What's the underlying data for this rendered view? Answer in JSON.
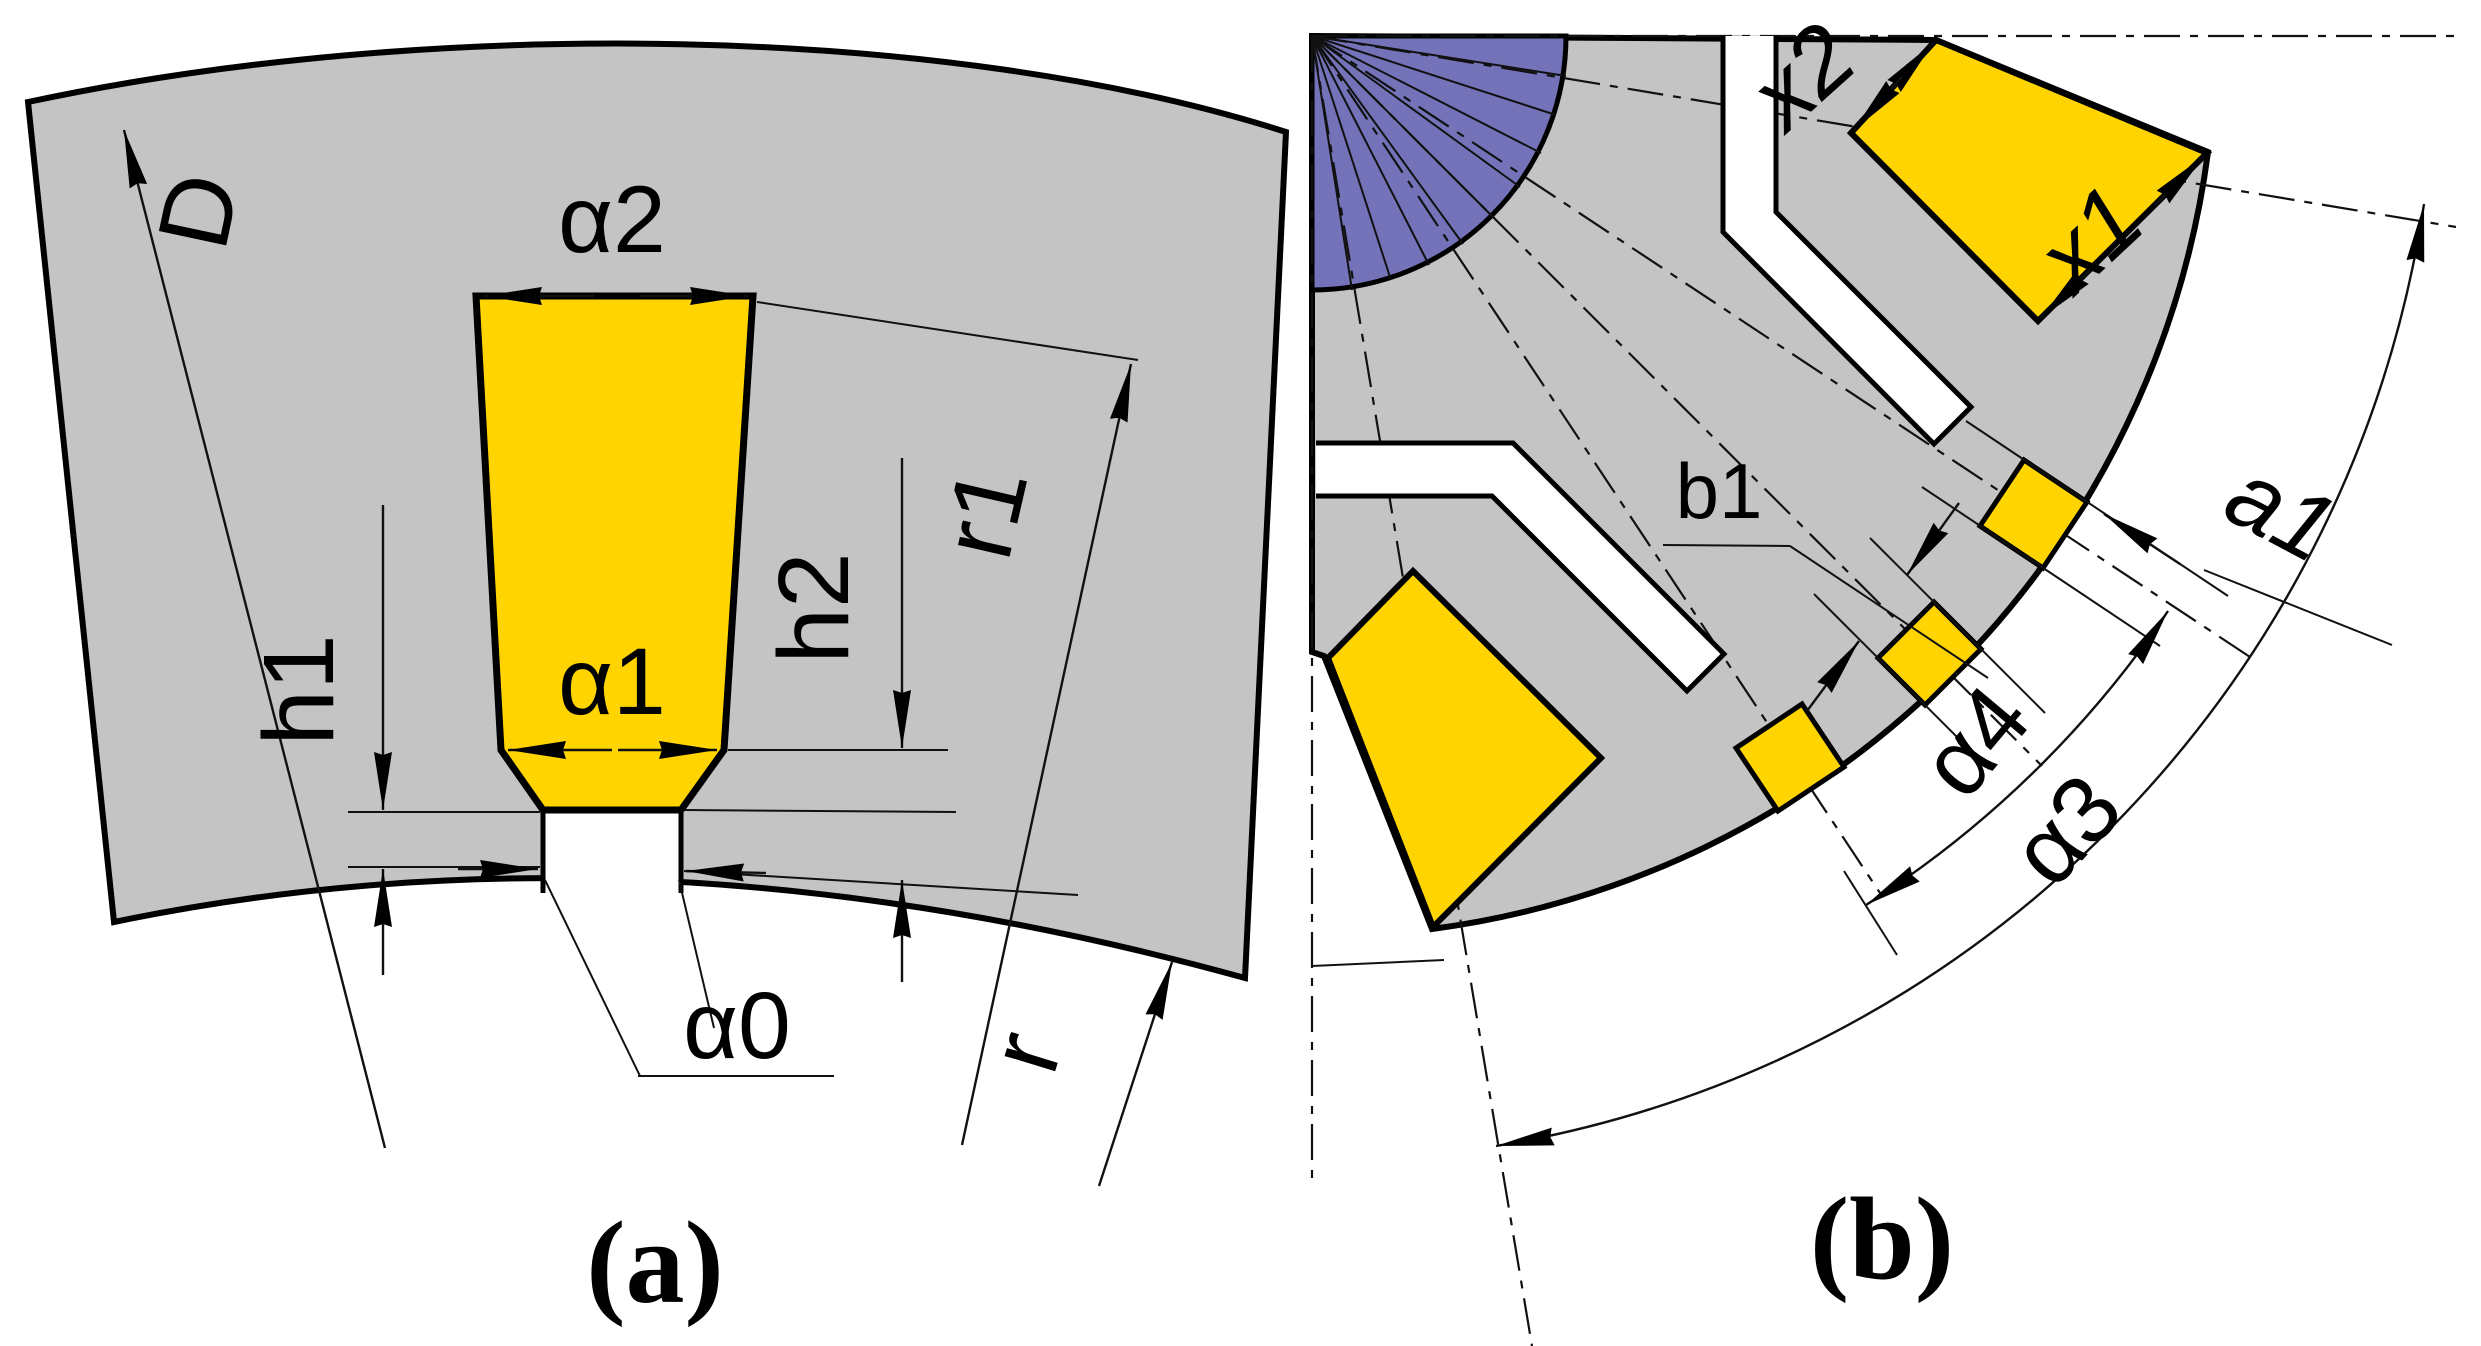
{
  "colors": {
    "steel_gray": "#C4C4C4",
    "magnet_yellow": "#FFD400",
    "shaft_purple": "#7473B9",
    "slot_white": "#FFFFFF",
    "outline_black": "#000000"
  },
  "panel_a": {
    "caption": "(a)",
    "labels": {
      "D": "D",
      "alpha2": "α2",
      "h1": "h1",
      "h2": "h2",
      "r1": "r1",
      "alpha1": "α1",
      "alpha0": "α0",
      "r": "r"
    }
  },
  "panel_b": {
    "caption": "(b)",
    "labels": {
      "x2": "x2",
      "x1": "x1",
      "b1": "b1",
      "a1": "a1",
      "alpha4": "α4",
      "alpha3": "α3"
    }
  }
}
